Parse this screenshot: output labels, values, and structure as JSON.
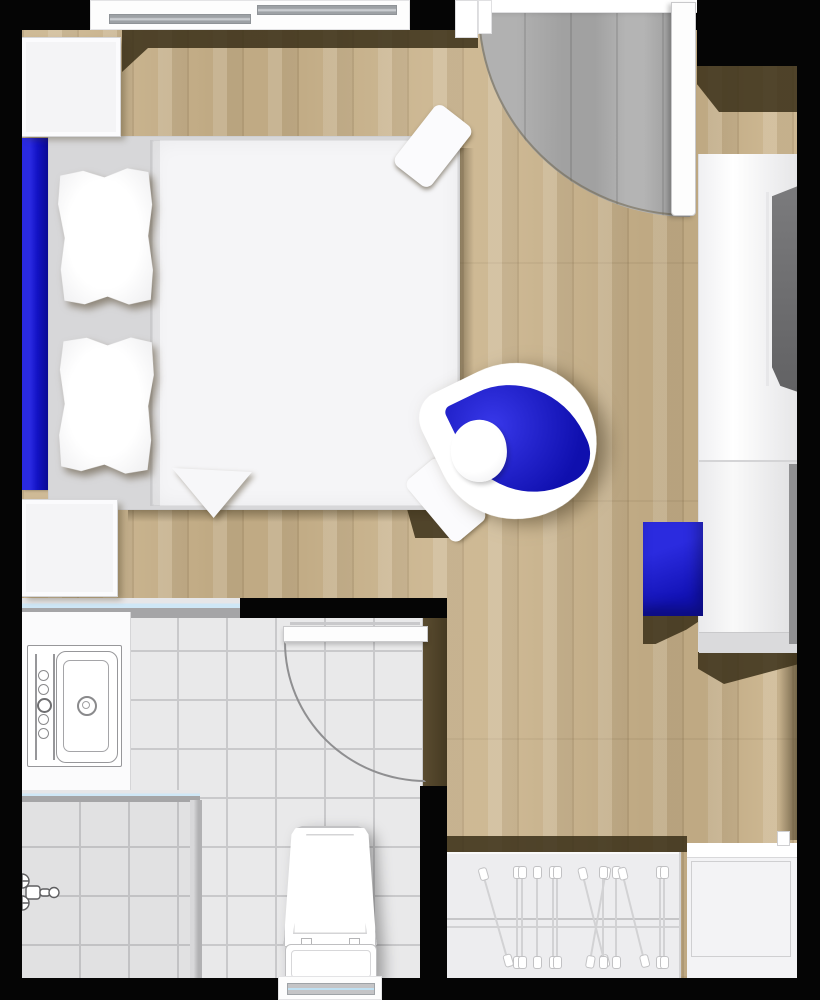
{
  "plan_title": "studio-room-floor-plan",
  "palette": {
    "wall_black": "#050505",
    "wood_floor": "#c9b28a",
    "wood_shadow": "#3a2f18",
    "entry_gray_floor": "#cfcfcf",
    "bathroom_tile": "#e9e9ea",
    "tile_grout": "#c9c9cb",
    "accent_blue": "#1414cd",
    "glass_blue": "#cfe7f6",
    "furniture_white": "#f5f5f7",
    "bed_frame_gray": "#d7d7d9",
    "tv_gray": "#6f6f71"
  },
  "objects": [
    "double-bed",
    "pillow",
    "blue-headboard",
    "nightstand",
    "entry-door",
    "door-swing-arc",
    "windows",
    "desk-counter",
    "tv",
    "armchair",
    "round-pillow",
    "blue-ottoman",
    "sink-unit",
    "shower-mixer",
    "glass-partition",
    "toilet",
    "bathroom-door",
    "wardrobe-closet",
    "clothes-hanger",
    "hanger-rail",
    "bench-luggage-rack"
  ],
  "counts": {
    "pillows": 2,
    "nightstands": 2,
    "hangers": 13,
    "doors": 2,
    "windows": 3
  },
  "closet": {
    "hangers": [
      {
        "x": 48,
        "tilt": -16
      },
      {
        "x": 70,
        "tilt": 0
      },
      {
        "x": 75,
        "tilt": 0
      },
      {
        "x": 90,
        "tilt": 0
      },
      {
        "x": 106,
        "tilt": 0
      },
      {
        "x": 110,
        "tilt": 0
      },
      {
        "x": 146,
        "tilt": -14
      },
      {
        "x": 151,
        "tilt": 10
      },
      {
        "x": 156,
        "tilt": 0
      },
      {
        "x": 169,
        "tilt": 0
      },
      {
        "x": 186,
        "tilt": -14
      },
      {
        "x": 213,
        "tilt": 0
      },
      {
        "x": 217,
        "tilt": 0
      }
    ]
  }
}
